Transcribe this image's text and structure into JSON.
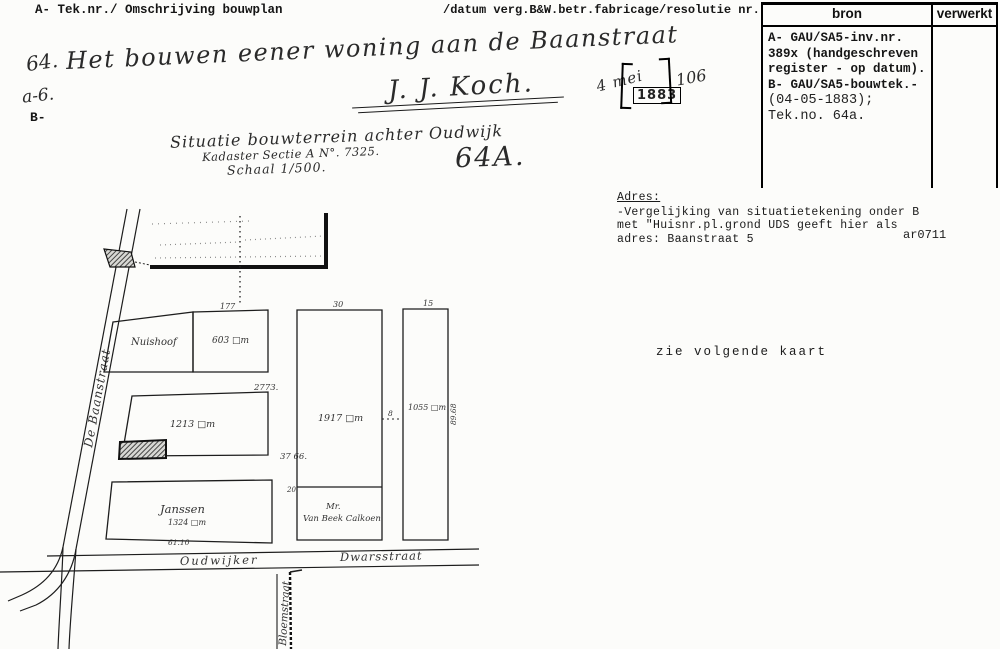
{
  "header": {
    "left": "A- Tek.nr./ Omschrijving bouwplan",
    "right": "/datum verg.B&W.betr.fabricage/resolutie nr."
  },
  "bron_box": {
    "bron_header": "bron",
    "verwerkt_header": "verwerkt",
    "line1": "A- GAU/SA5-inv.nr.",
    "line2": "389x (handgeschreven",
    "line3": "register - op datum).",
    "line4": "B- GAU/SA5-bouwtek.-",
    "line5": "(04-05-1883);",
    "line6": "Tek.no. 64a."
  },
  "entry": {
    "number": "64.",
    "title": "Het bouwen eener woning aan de Baanstraat",
    "signature": "J. J. Koch.",
    "sub_number": "a-6.",
    "b_mark": "B-",
    "date_handwritten": "4 mei",
    "year_stamp": "1883",
    "resolution_number": "106"
  },
  "caption": {
    "line1": "Situatie bouwterrein achter Oudwijk",
    "line2": "Kadaster Sectie A N°. 7325.",
    "line3": "Schaal 1/500.",
    "sheet_number": "64A."
  },
  "adres": {
    "heading": "Adres:",
    "line1": "-Vergelijking van situatietekening onder B",
    "line2": "met \"Huisnr.pl.grond UDS geeft hier als",
    "line3": "adres: Baanstraat 5",
    "code": "ar0711"
  },
  "note": {
    "text": "zie volgende kaart"
  },
  "map": {
    "streets": {
      "left": "De Baanstraat",
      "bottom_left": "Oudwijker",
      "bottom_right": "Dwarsstraat",
      "lane": "Bloemstraat"
    },
    "plots": {
      "a_name": "Nuishoof",
      "b_area": "603 □m",
      "c_area": "1213 □m",
      "d_area": "1917 □m",
      "e_area": "1055 □m",
      "f_name": "Janssen",
      "f_area": "1324 □m",
      "g_title": "Mr.",
      "g_name": "Van Beek Calkoen"
    },
    "dims": {
      "top_b": "177",
      "width_c": "2773.",
      "width_d": "30",
      "width_e": "15",
      "gap_de": "8",
      "d3766": "37 66.",
      "bottom_f": "61.10",
      "height_e": "89.68",
      "d20": "20"
    }
  }
}
